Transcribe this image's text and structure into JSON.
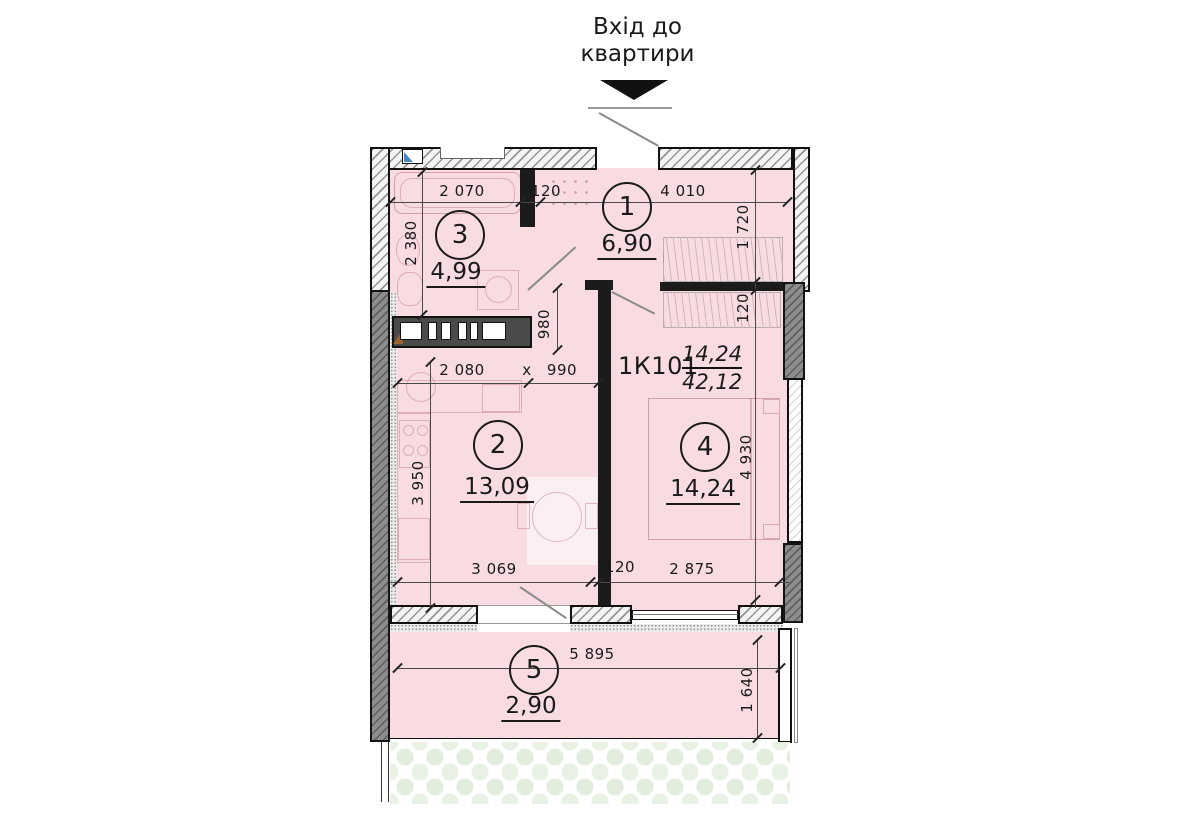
{
  "title": {
    "line1": "Вхід до",
    "line2": "квартири"
  },
  "apartment": {
    "code": "1К101",
    "room_area": "14,24",
    "total_area": "42,12"
  },
  "rooms": [
    {
      "number": "1",
      "area": "6,90"
    },
    {
      "number": "2",
      "area": "13,09"
    },
    {
      "number": "3",
      "area": "4,99"
    },
    {
      "number": "4",
      "area": "14,24"
    },
    {
      "number": "5",
      "area": "2,90"
    }
  ],
  "dims": [
    {
      "id": "room3-width",
      "text": "2 070"
    },
    {
      "id": "wall-120-top",
      "text": "120"
    },
    {
      "id": "hall-width",
      "text": "4 010"
    },
    {
      "id": "hall-depth",
      "text": "1 720"
    },
    {
      "id": "room3-depth",
      "text": "2 380"
    },
    {
      "id": "wall-120-right",
      "text": "120"
    },
    {
      "id": "corridor-depth",
      "text": "980"
    },
    {
      "id": "kitchen-width",
      "text": "2 080"
    },
    {
      "id": "times",
      "text": "x"
    },
    {
      "id": "corridor-width",
      "text": "990"
    },
    {
      "id": "room2-depth",
      "text": "3 950"
    },
    {
      "id": "room4-depth",
      "text": "4 930"
    },
    {
      "id": "room2-width",
      "text": "3 069"
    },
    {
      "id": "wall-120-bottom",
      "text": "120"
    },
    {
      "id": "room4-width",
      "text": "2 875"
    },
    {
      "id": "balcony-width",
      "text": "5 895"
    },
    {
      "id": "balcony-depth",
      "text": "1 640"
    }
  ],
  "colors": {
    "room_fill": "#f8dce2",
    "wall_dark": "#8d8d8d",
    "vent_accent": "#4a86c2",
    "shaft_marker": "#a0622d",
    "floral": "#e3edde"
  }
}
